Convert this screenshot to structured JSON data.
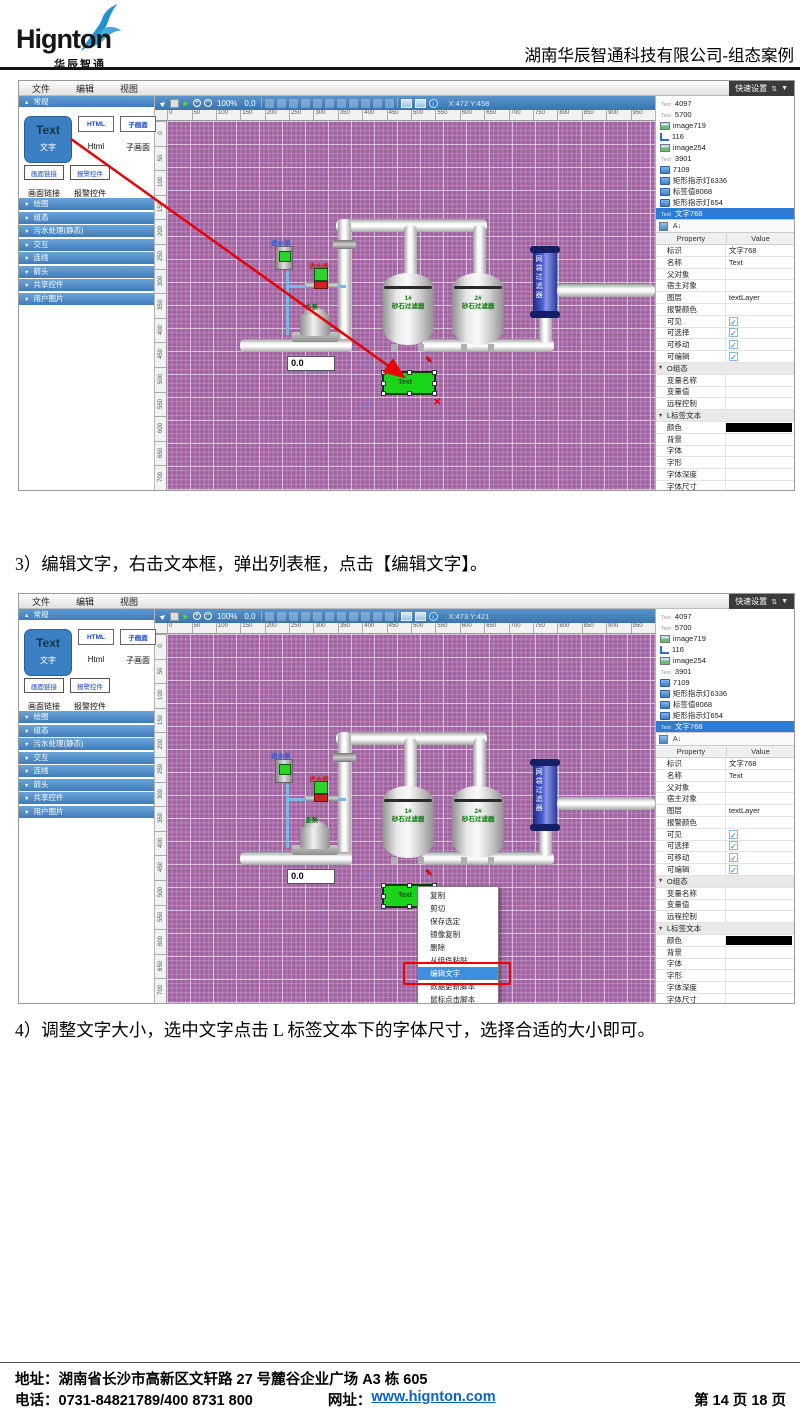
{
  "page": {
    "logo": {
      "brand": "Hignton",
      "sub": "华辰智通"
    },
    "header_right": "湖南华辰智通科技有限公司-组态案例",
    "step3": "3）编辑文字，右击文本框，弹出列表框，点击【编辑文字】。",
    "step4": "4）调整文字大小，选中文字点击 L 标签文本下的字体尺寸，选择合适的大小即可。",
    "footer": {
      "address": "地址：湖南省长沙市高新区文轩路 27 号麓谷企业广场 A3 栋 605",
      "phone": "电话：0731-84821789/400 8731 800",
      "web_label": "网址：",
      "web_url": "www.hignton.com",
      "page_info": "第 14 页 18 页"
    }
  },
  "icons": {
    "cursor": "►",
    "run": "►",
    "zoom_in": "+",
    "zoom_out": "−",
    "info": "i",
    "up_down_arrows": "⇅",
    "chevron_down": "▼",
    "sort": "A↓",
    "pen": "✎",
    "close": "✕"
  },
  "editor": {
    "menu": [
      "文件",
      "编辑",
      "视图"
    ],
    "quick_settings": "快速设置",
    "palette": {
      "section": "常规",
      "text_btn": {
        "big": "Text",
        "caption": "文字"
      },
      "html_btn": {
        "big": "HTML",
        "caption": "Html"
      },
      "sub_btn": {
        "big": "子画面",
        "caption": "子画面"
      },
      "link_btn": {
        "big": "画面链接",
        "caption": "画面链接"
      },
      "alarm_btn": {
        "big": "报警控件",
        "caption": "报警控件"
      },
      "sections": [
        "绘图",
        "组态",
        "污水处理(静态)",
        "交互",
        "连线",
        "箭头",
        "共享控件",
        "用户图片"
      ]
    },
    "toolbar": {
      "zoom": "100%",
      "origin": "0,0"
    },
    "ruler_h": [
      "0",
      "50",
      "100",
      "150",
      "200",
      "250",
      "300",
      "350",
      "400",
      "450",
      "500",
      "550",
      "600",
      "650",
      "700",
      "750",
      "800",
      "850",
      "900",
      "950"
    ],
    "ruler_v": [
      "0",
      "50",
      "100",
      "150",
      "200",
      "250",
      "300",
      "350",
      "400",
      "450",
      "500",
      "550",
      "600",
      "650",
      "700"
    ],
    "diagram": {
      "pump_in": "进水泵",
      "valve_in": "进水阀",
      "main_pump": "主泵",
      "tank1_no": "1#",
      "tank1_name": "砂石过滤器",
      "tank2_no": "2#",
      "tank2_name": "砂石过滤器",
      "cylinder": "网袋过滤器",
      "value": "0.0",
      "text_el": "Text"
    },
    "tree": [
      {
        "icon": "text",
        "label": "4097"
      },
      {
        "icon": "text",
        "label": "5700"
      },
      {
        "icon": "image",
        "label": "image719"
      },
      {
        "icon": "poly",
        "label": "116"
      },
      {
        "icon": "image",
        "label": "image254"
      },
      {
        "icon": "text",
        "label": "3901"
      },
      {
        "icon": "screen",
        "label": "7109"
      },
      {
        "icon": "screen",
        "label": "矩形指示灯6336"
      },
      {
        "icon": "screen",
        "label": "标签值8068"
      },
      {
        "icon": "screen",
        "label": "矩形指示灯654"
      },
      {
        "icon": "text",
        "label": "文字768",
        "sel": "1"
      }
    ],
    "props_header": {
      "property": "Property",
      "value": "Value"
    },
    "props": [
      {
        "label": "标识",
        "value": "文字768",
        "type": "text"
      },
      {
        "label": "名称",
        "value": "Text",
        "type": "text"
      },
      {
        "label": "父对象",
        "value": "",
        "type": "text"
      },
      {
        "label": "宿主对象",
        "value": "",
        "type": "text"
      },
      {
        "label": "图层",
        "value": "textLayer",
        "type": "text"
      },
      {
        "label": "报警颜色",
        "value": "",
        "type": "text"
      },
      {
        "label": "可见",
        "type": "check"
      },
      {
        "label": "可选择",
        "type": "check"
      },
      {
        "label": "可移动",
        "type": "check"
      },
      {
        "label": "可编辑",
        "type": "check"
      },
      {
        "label": "O组态",
        "type": "group"
      },
      {
        "label": "变量名称",
        "value": "",
        "type": "text"
      },
      {
        "label": "变量值",
        "value": "",
        "type": "text"
      },
      {
        "label": "远程控制",
        "value": "",
        "type": "text"
      },
      {
        "label": "L标签文本",
        "type": "group"
      },
      {
        "label": "颜色",
        "type": "swatch"
      },
      {
        "label": "背景",
        "value": "",
        "type": "text"
      },
      {
        "label": "字体",
        "value": "",
        "type": "text"
      },
      {
        "label": "字形",
        "value": "",
        "type": "text"
      },
      {
        "label": "字体深度",
        "value": "",
        "type": "text"
      },
      {
        "label": "字体尺寸",
        "value": "",
        "type": "text"
      },
      {
        "label": "位置",
        "value": "16",
        "type": "text"
      },
      {
        "label": "x偏移",
        "value": "0",
        "type": "text"
      }
    ]
  },
  "shots": [
    {
      "coords": "X:472 Y:458"
    },
    {
      "coords": "X:473 Y:421"
    }
  ],
  "context_menu": {
    "items": [
      {
        "label": "复制"
      },
      {
        "label": "剪切"
      },
      {
        "label": "保存选定"
      },
      {
        "label": "镜像复制"
      },
      {
        "label": "删除"
      },
      {
        "label": "从组件粘贴"
      },
      {
        "label": "编辑文字",
        "hl": "1"
      },
      {
        "label": "数据更新脚本"
      },
      {
        "label": "鼠标点击脚本"
      }
    ]
  },
  "colors": {
    "accent_blue": "#3f7cba",
    "canvas_purple": "#a263a2",
    "selection_blue": "#2e7cd6",
    "annotation_red": "#ee0000",
    "link_blue": "#0a62c5"
  }
}
